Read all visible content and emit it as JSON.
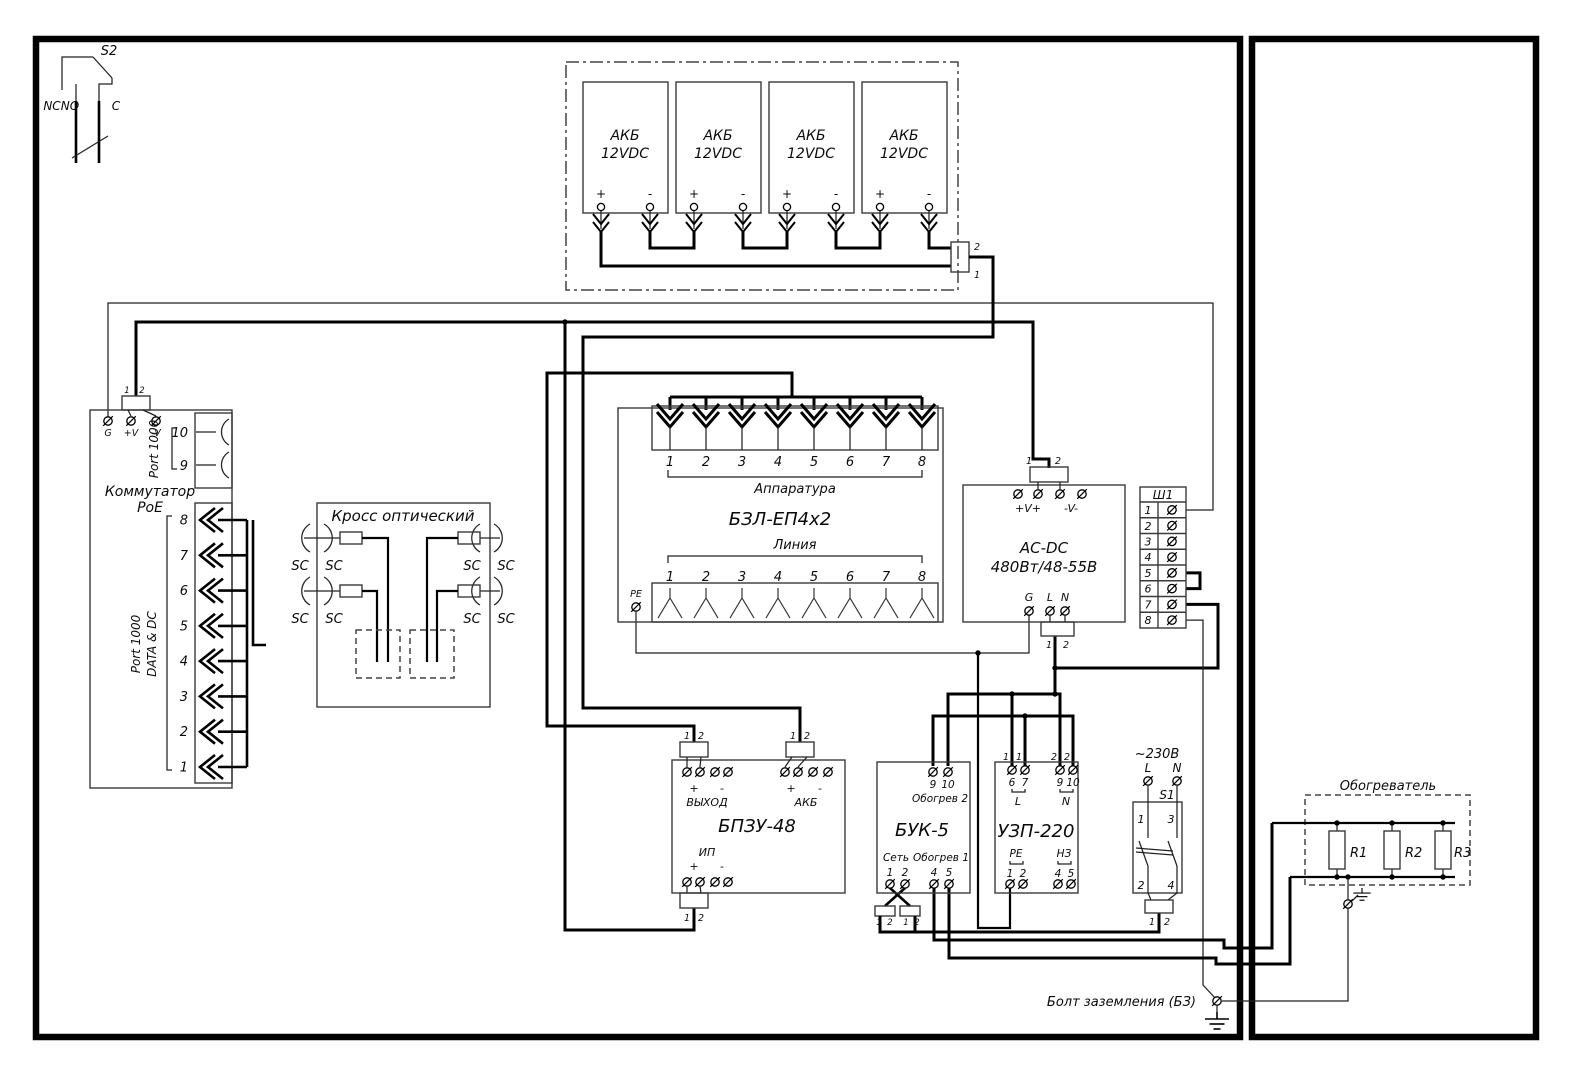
{
  "colors": {
    "ink": "#000000",
    "background": "#ffffff"
  },
  "s2": {
    "name": "S2",
    "nc": "NC",
    "no": "NO",
    "c": "C"
  },
  "battery": {
    "plus": "+",
    "minus": "-",
    "w1": "1",
    "w2": "2",
    "cells": [
      {
        "l1": "АКБ",
        "l2": "12VDC"
      },
      {
        "l1": "АКБ",
        "l2": "12VDC"
      },
      {
        "l1": "АКБ",
        "l2": "12VDC"
      },
      {
        "l1": "АКБ",
        "l2": "12VDC"
      }
    ]
  },
  "poe": {
    "title1": "Коммутатор",
    "title2": "PoE",
    "g": "G",
    "vplus": "+V",
    "vminus": "-V",
    "c1": "1",
    "c2": "2",
    "port1000": "Port 1000",
    "p10": "10",
    "p9": "9",
    "data_dc": "DATA & DC",
    "ports": [
      "8",
      "7",
      "6",
      "5",
      "4",
      "3",
      "2",
      "1"
    ]
  },
  "cross": {
    "title": "Кросс оптический",
    "sc": "SC"
  },
  "bzl": {
    "title": "БЗЛ-ЕП4х2",
    "apparatura": "Аппаратура",
    "linia": "Линия",
    "pe": "PE",
    "terms": [
      "1",
      "2",
      "3",
      "4",
      "5",
      "6",
      "7",
      "8"
    ]
  },
  "acdc": {
    "title1": "AC-DC",
    "title2": "480Вт/48-55В",
    "vplus": "+V+",
    "vminus": "-V-",
    "g": "G",
    "l": "L",
    "n": "N",
    "c1": "1",
    "c2": "2"
  },
  "sh1": {
    "title": "Ш1",
    "rows": [
      "1",
      "2",
      "3",
      "4",
      "5",
      "6",
      "7",
      "8"
    ]
  },
  "bpzu": {
    "title": "БПЗУ-48",
    "out": "ВЫХОД",
    "akb": "АКБ",
    "ip": "ИП",
    "plus": "+",
    "minus": "-",
    "c1": "1",
    "c2": "2"
  },
  "buk": {
    "title": "БУК-5",
    "net": "Сеть",
    "heat1": "Обогрев 1",
    "heat2": "Обогрев 2",
    "n9": "9",
    "n10": "10",
    "n1": "1",
    "n2": "2",
    "n4": "4",
    "n5": "5",
    "c1": "1",
    "c2": "2"
  },
  "uzp": {
    "title": "УЗП-220",
    "l": "L",
    "n": "N",
    "pe": "РЕ",
    "nz": "НЗ",
    "n6": "6",
    "n7": "7",
    "n9": "9",
    "n10": "10",
    "n1": "1",
    "n2": "2",
    "n4": "4",
    "n5": "5",
    "w1": "1",
    "w2": "2"
  },
  "s1": {
    "name": "S1",
    "voltage": "~230В",
    "l": "L",
    "n": "N",
    "k1": "1",
    "k2": "2",
    "k3": "3",
    "k4": "4",
    "c1": "1",
    "c2": "2"
  },
  "heater": {
    "title": "Обогреватель",
    "r1": "R1",
    "r2": "R2",
    "r3": "R3"
  },
  "ground": {
    "bolt_label": "Болт заземления (БЗ)"
  }
}
